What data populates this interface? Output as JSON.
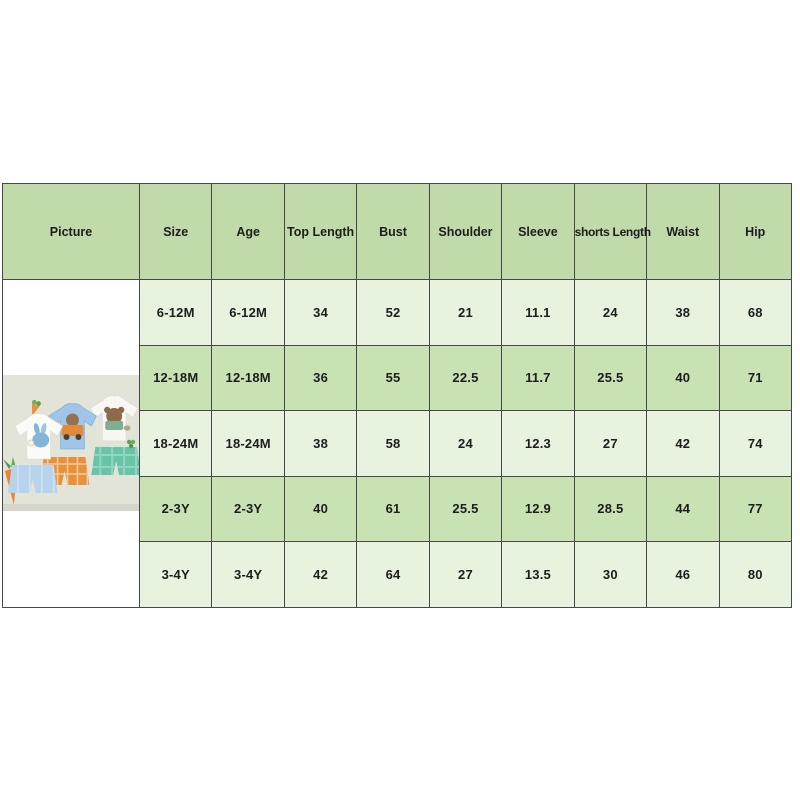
{
  "size_chart": {
    "columns": [
      "Picture",
      "Size",
      "Age",
      "Top Length",
      "Bust",
      "Shoulder",
      "Sleeve",
      "shorts Length",
      "Waist",
      "Hip"
    ],
    "rows": [
      [
        "6-12M",
        "6-12M",
        "34",
        "52",
        "21",
        "11.1",
        "24",
        "38",
        "68"
      ],
      [
        "12-18M",
        "12-18M",
        "36",
        "55",
        "22.5",
        "11.7",
        "25.5",
        "40",
        "71"
      ],
      [
        "18-24M",
        "18-24M",
        "38",
        "58",
        "24",
        "12.3",
        "27",
        "42",
        "74"
      ],
      [
        "2-3Y",
        "2-3Y",
        "40",
        "61",
        "25.5",
        "12.9",
        "28.5",
        "44",
        "77"
      ],
      [
        "3-4Y",
        "3-4Y",
        "42",
        "64",
        "27",
        "13.5",
        "30",
        "46",
        "80"
      ]
    ],
    "picture": {
      "name": "toddler-shirt-shorts-sets-photo"
    },
    "colors": {
      "header_bg": "#c0daa9",
      "row_light_bg": "#e7f2df",
      "row_dark_bg": "#c9e2b3",
      "border": "#474747",
      "text": "#1d1d1d",
      "page_bg": "#ffffff",
      "photo_bg": "#e3e4d8"
    }
  }
}
